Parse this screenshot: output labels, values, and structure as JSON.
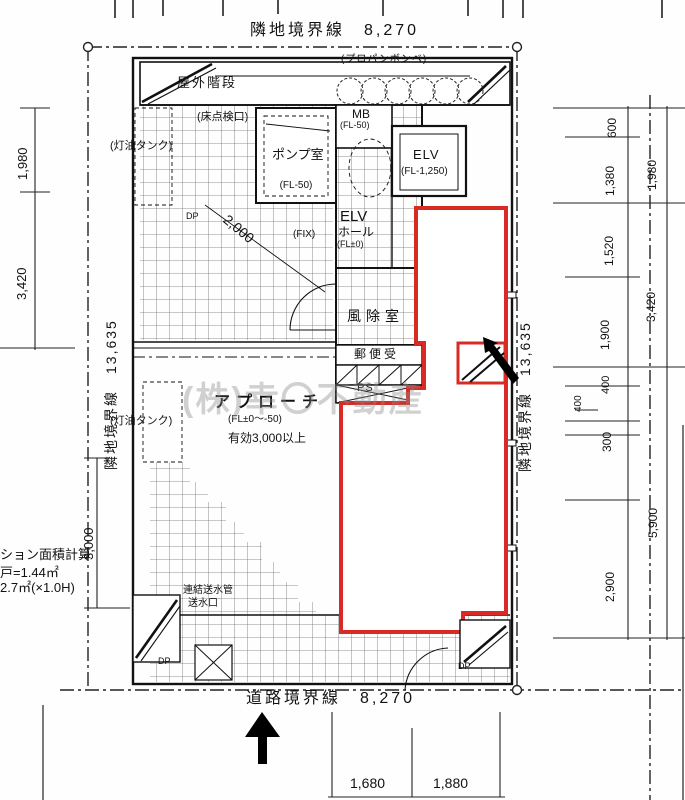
{
  "boundaries": {
    "top": "隣地境界線　8,270",
    "bottom": "道路境界線　8,270",
    "left": "隣地境界線　13,635",
    "right": "隣地境界線　13,635"
  },
  "dims": {
    "left_1": "1,980",
    "left_2": "3,420",
    "left_3": "3,000",
    "diag": "2,000",
    "r_in_1": "600",
    "r_in_2": "1,380",
    "r_in_3": "1,520",
    "r_in_4": "1,900",
    "r_in_5": "400",
    "r_in_6": "400",
    "r_in_7": "300",
    "r_in_8": "2,900",
    "r_out_1": "1,980",
    "r_out_2": "3,420",
    "r_out_3": "5,900",
    "b_1": "1,680",
    "b_2": "1,880"
  },
  "rooms": {
    "outdoor_stairs": "屋外階段",
    "propane": "(プロパンボンベ)",
    "floor_hatch": "(床点検口)",
    "oil_tank": "(灯油タンク)",
    "pump_name": "ポンプ室",
    "pump_fl": "(FL-50)",
    "mb_name": "MB",
    "mb_fl": "(FL-50)",
    "elv_name": "ELV",
    "elv_fl": "(FL-1,250)",
    "hall_1": "ELV",
    "hall_2": "ホール",
    "hall_3": "(FL±0)",
    "fix": "(FIX)",
    "windbreak": "風除室",
    "mailbox": "郵便受",
    "ps": "PS",
    "approach_name": "アプローチ",
    "approach_fl": "(FL±0〜-50)",
    "approach_note": "有効3,000以上",
    "standpipe_1": "連結送水管",
    "standpipe_2": "送水口",
    "dp": "DP"
  },
  "notes": {
    "calc_1": "ション面積計算",
    "calc_2": "戸=1.44㎡",
    "calc_3": "2.7㎡(×1.0H)",
    "watermark": "(株)幸〇不動産"
  },
  "colors": {
    "unit_outline": "#d92b25",
    "line": "#1a1a1a"
  }
}
